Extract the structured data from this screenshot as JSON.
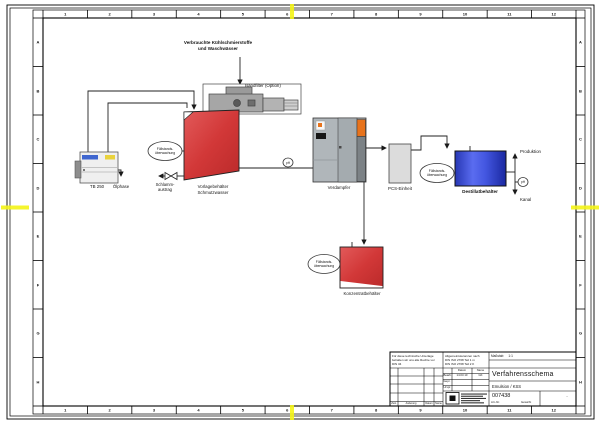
{
  "border": {
    "columns": [
      "1",
      "2",
      "3",
      "4",
      "5",
      "6",
      "7",
      "8",
      "9",
      "10",
      "11",
      "12"
    ],
    "rows": [
      "A",
      "B",
      "C",
      "D",
      "E",
      "F",
      "G",
      "H"
    ]
  },
  "diagram": {
    "feed_label": "Verbrauchte Kühlschmierstoffe\nund Waschwässer",
    "bandfilter_label": "Bandfilter (Option)",
    "tb250_label": "TB 250",
    "oelphase_label": "Ölphase",
    "schlamm_label": "Schlamm-\naustrag",
    "vorlage_label": "Vorlagebehälter\nSchmutzwasser",
    "level_monitor_label": "Füllstands-\nüberwachung",
    "verdampfer_label": "Verdampfer",
    "pcs_label": "PCS-Einheit",
    "konzentrat_label": "Konzentratbehälter",
    "destillat_label": "Destillatbehälter",
    "produktion_label": "Produktion",
    "kanal_label": "Kanal",
    "ph_label": "pH"
  },
  "title_block": {
    "rights_note": "Für diese technische Unterlage\nbehalten wir uns alle Rechte vor\nDIN 34",
    "tolerances": "Allgemeintoleranzen nach\nDIN ISO 2768 Teil 1 m\nDIN ISO 2768 Teil 2 K",
    "scale_label": "Maßstab",
    "scale_value": "1:1",
    "col_datum": "Datum",
    "col_name": "Name",
    "bearb_label": "Bearb.",
    "bearb_date": "14.03.10",
    "bearb_name": "GK",
    "gepr_label": "Gepr.",
    "urspr_label": "Urspr.",
    "rev_zust": "Zust.",
    "rev_aenderung": "Änderung",
    "rev_datum": "Datum",
    "rev_name": "Name",
    "title": "Verfahrensschema",
    "subtitle": "Emulsion / KSS",
    "part_number": "007438",
    "part_number_label": "Art.-Nr.",
    "weight_label": "Gewicht",
    "weight_value": "-"
  },
  "colors": {
    "tank_red": "#d23838",
    "tank_blue": "#3a4ed6",
    "accent_orange": "#e8731c",
    "center_mark_yellow": "#f4f416",
    "machine_gray": "#a6a6a6"
  }
}
